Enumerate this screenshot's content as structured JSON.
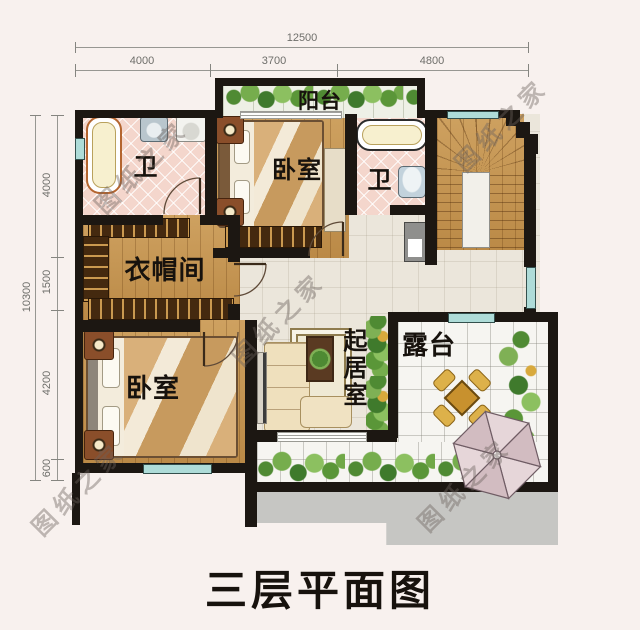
{
  "title": "三层平面图",
  "watermark": {
    "text": "图纸之家"
  },
  "dimensions": {
    "top": {
      "total": "12500",
      "segments": [
        "4000",
        "3700",
        "4800"
      ]
    },
    "left": {
      "total": "10300",
      "segments": [
        "4000",
        "1500",
        "4200",
        "600"
      ]
    }
  },
  "rooms": {
    "balcony": "阳台",
    "bath_left": "卫",
    "bedroom_top": "卧室",
    "bath_right": "卫",
    "closet": "衣帽间",
    "bedroom_bottom": "卧室",
    "living": "起居室",
    "terrace": "露台"
  },
  "palette": {
    "wall": "#1c1712",
    "wood_floor": "#c6954f",
    "bath_tile": "#f4d6cc",
    "hall_tile": "#ebe6db",
    "terrace_tile": "#f6f5f1",
    "window": "#aedcd8",
    "greenery": "#5a9638",
    "roof_gray": "#c6c6c3",
    "dimension_text": "#6e6e6a"
  }
}
